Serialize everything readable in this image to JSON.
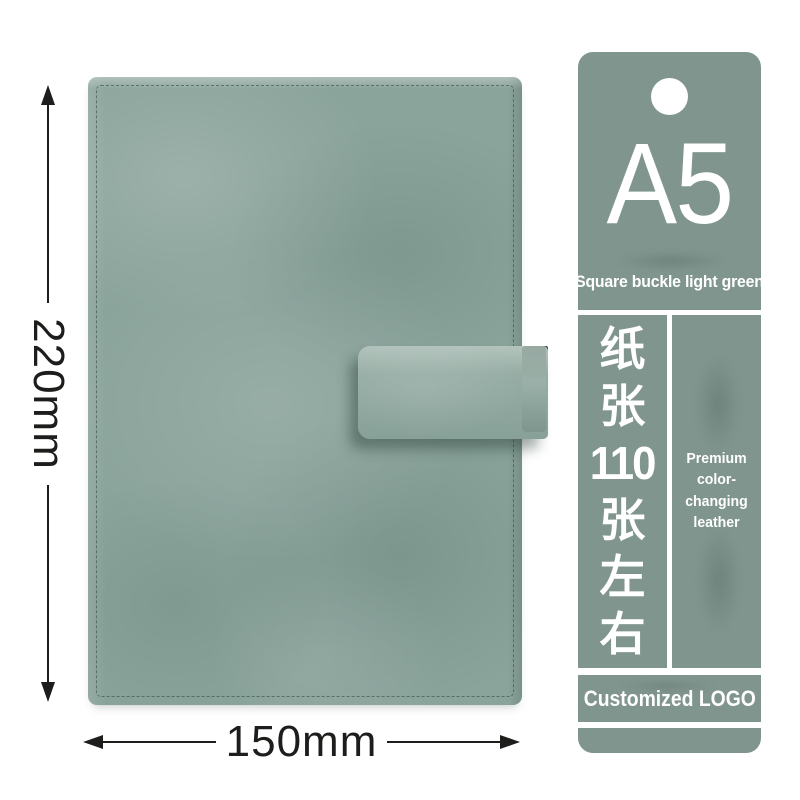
{
  "product": {
    "height_label": "220mm",
    "width_label": "150mm",
    "cover_color": "#8aa39b",
    "strap_color": "#90a89f",
    "stitch_color": "#34524a"
  },
  "tag": {
    "bg_color": "#80958e",
    "text_color": "#ffffff",
    "size_label": "A5",
    "subtitle": "Square buckle light green",
    "paper_spec_text": "纸张110张左右",
    "paper_spec_vertical": [
      "纸",
      "张",
      "110",
      "张",
      "左",
      "右"
    ],
    "material_lines": [
      "Premium color-",
      "changing",
      "leather"
    ],
    "logo_text": "Customized LOGO"
  },
  "annotation": {
    "line_color": "#1d1d1b"
  }
}
